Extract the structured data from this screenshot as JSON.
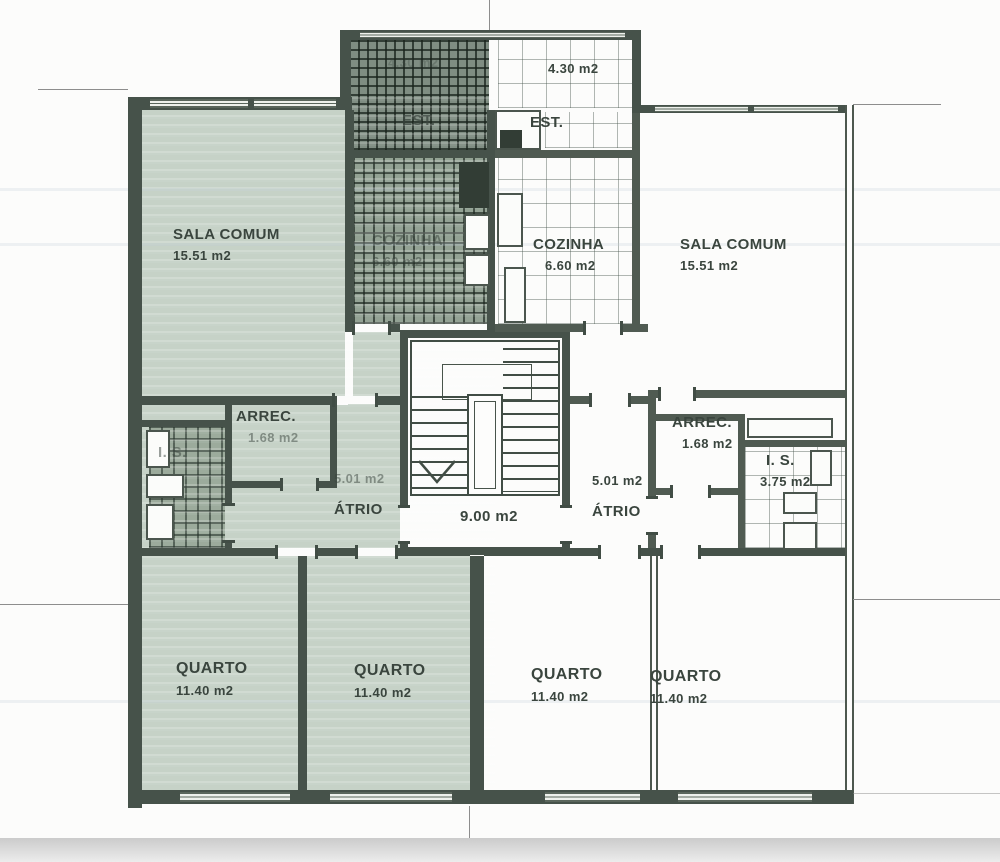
{
  "plan": {
    "stairwell": {
      "area": "9.00 m2"
    },
    "apartments": {
      "left": {
        "sala": {
          "name": "SALA COMUM",
          "area": "15.51 m2"
        },
        "cozinha": {
          "name": "COZINHA",
          "area": "6.60 m2"
        },
        "est": {
          "name": "EST.",
          "area": "4.30 m2"
        },
        "arrec": {
          "name": "ARREC.",
          "area": "1.68 m2"
        },
        "is": {
          "name": "I. S."
        },
        "atrio": {
          "name": "ÁTRIO",
          "area": "5.01 m2"
        },
        "quarto1": {
          "name": "QUARTO",
          "area": "11.40 m2"
        },
        "quarto2": {
          "name": "QUARTO",
          "area": "11.40 m2"
        }
      },
      "right": {
        "est": {
          "name": "EST.",
          "area": "4.30 m2"
        },
        "cozinha": {
          "name": "COZINHA",
          "area": "6.60 m2"
        },
        "sala": {
          "name": "SALA COMUM",
          "area": "15.51 m2"
        },
        "arrec": {
          "name": "ARREC.",
          "area": "1.68 m2"
        },
        "is": {
          "name": "I. S.",
          "area": "3.75 m2"
        },
        "atrio": {
          "name": "ÁTRIO",
          "area": "5.01 m2"
        },
        "quarto1": {
          "name": "QUARTO",
          "area": "11.40 m2"
        },
        "quarto2": {
          "name": "QUARTO",
          "area": "11.40 m2"
        }
      }
    },
    "colors": {
      "highlight": "#c6d2c7",
      "wall": "#46524a",
      "text": "#3a453e"
    }
  }
}
